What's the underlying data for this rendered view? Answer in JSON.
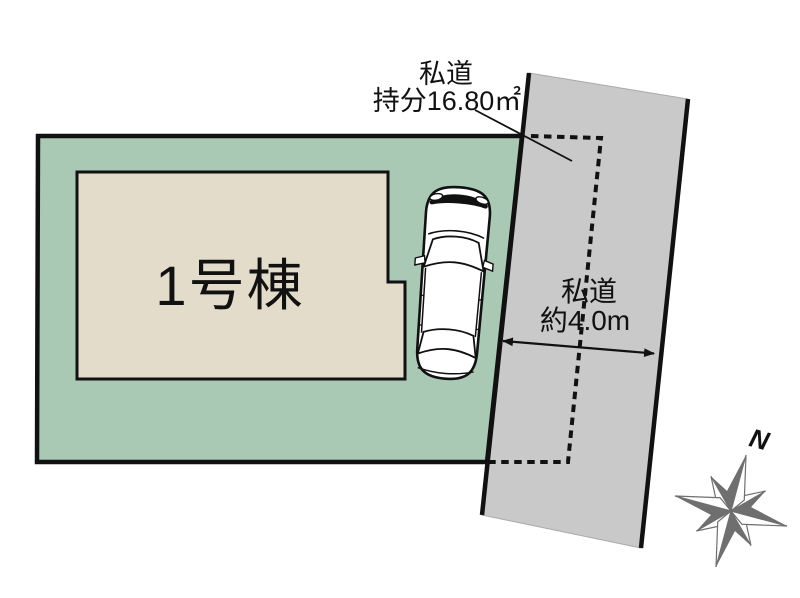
{
  "diagram": {
    "building": {
      "label": "1号棟"
    },
    "private_road": {
      "name": "私道",
      "width_label": "約4.0m",
      "share": {
        "name": "私道",
        "amount_label": "持分16.80㎡"
      }
    },
    "compass": {
      "north": "N"
    }
  },
  "colors": {
    "plot_green": "#a9c9b5",
    "building_beige": "#e3dcca",
    "road_gray": "#c9c9c9",
    "outline_black": "#111111",
    "compass_gray": "#6f6f6f",
    "car_white": "#ffffff"
  }
}
